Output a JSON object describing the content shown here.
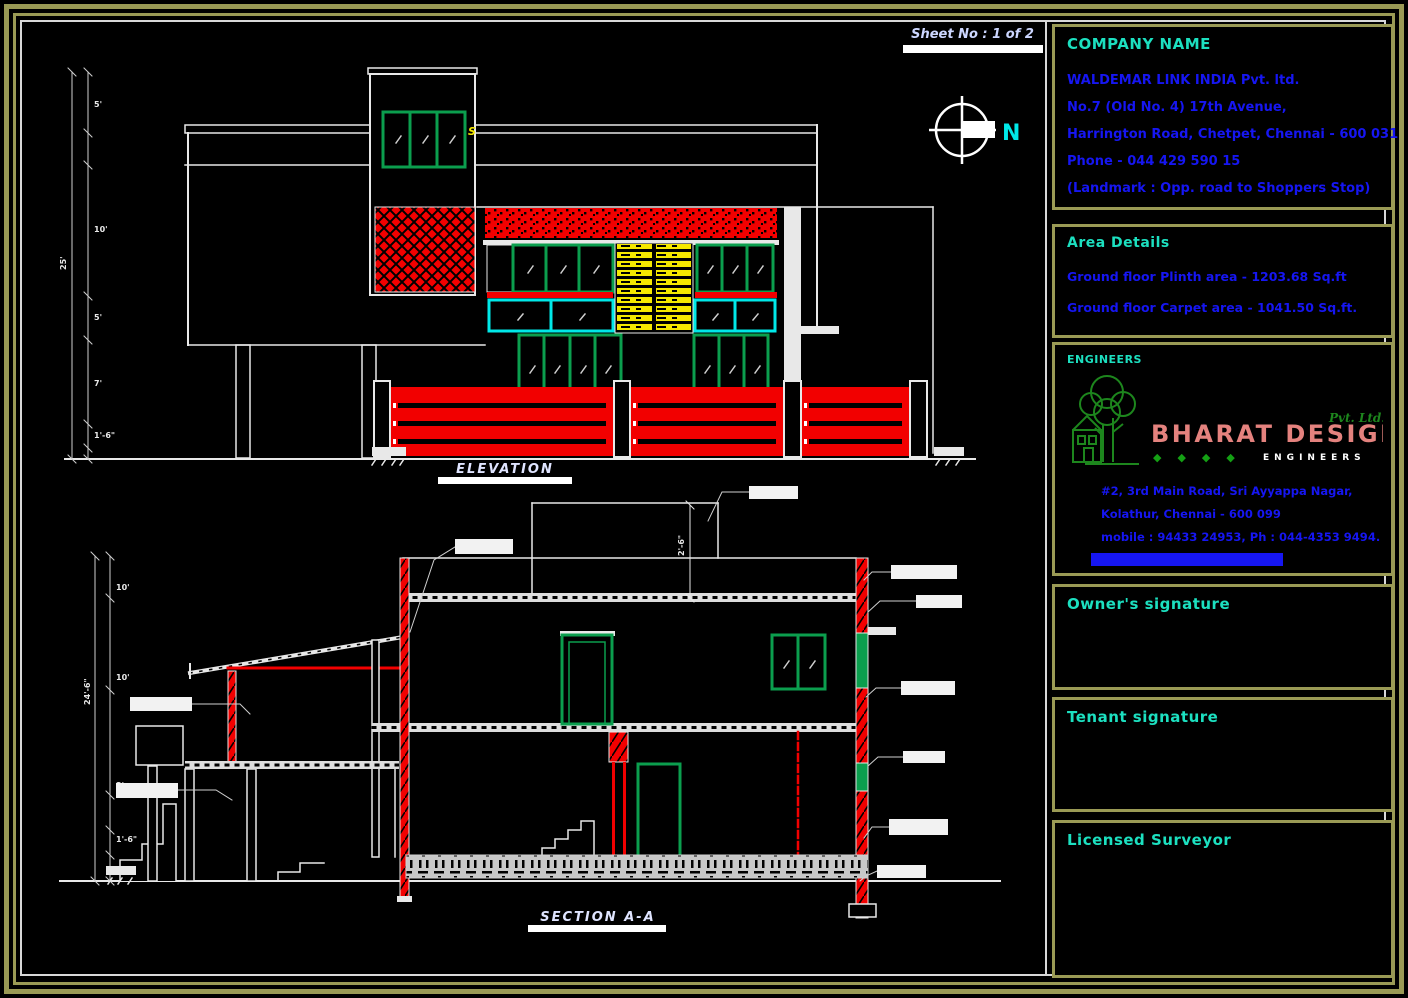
{
  "sheet": {
    "number_label": "Sheet No : 1 of 2"
  },
  "compass": {
    "north_label": "N"
  },
  "drawing": {
    "elevation": {
      "title": "ELEVATION",
      "marker": "S",
      "dims": {
        "total": "25'",
        "segments": [
          "5'",
          "10'",
          "5'",
          "7'",
          "1'-6\""
        ]
      }
    },
    "section": {
      "title": "SECTION A-A",
      "dims": {
        "total": "24'-6\"",
        "segments": [
          "10'",
          "10'",
          "3'",
          "1'-6\"",
          "2'"
        ],
        "mumty": "2'-6\""
      }
    }
  },
  "panels": {
    "company": {
      "heading": "COMPANY NAME",
      "lines": [
        "WALDEMAR LINK INDIA Pvt. ltd.",
        "No.7 (Old No. 4) 17th Avenue,",
        "Harrington Road, Chetpet, Chennai - 600 031",
        "Phone - 044 429 590 15",
        "(Landmark : Opp. road to Shoppers Stop)"
      ]
    },
    "area": {
      "heading": "Area Details",
      "lines": [
        "Ground floor Plinth area - 1203.68 Sq.ft",
        "Ground floor Carpet area - 1041.50 Sq.ft."
      ]
    },
    "engineers": {
      "heading": "ENGINEERS",
      "brand": "BHARAT DESIGN",
      "brand_suffix": "Pvt. Ltd.",
      "brand_tagline": "ENGINEERS",
      "diamonds": "◆◆◆◆",
      "address": [
        "#2, 3rd Main Road, Sri Ayyappa Nagar,",
        "Kolathur, Chennai - 600 099",
        "mobile : 94433 24953, Ph : 044-4353 9494."
      ]
    },
    "owner": {
      "heading": "Owner's signature"
    },
    "tenant": {
      "heading": "Tenant signature"
    },
    "surveyor": {
      "heading": "Licensed Surveyor"
    }
  },
  "colors": {
    "cad_red": "#f20000",
    "cad_green": "#0b9e4e",
    "cad_yellow": "#f5e800",
    "cad_cyan": "#00e8e8",
    "cad_blue": "#1616f2",
    "heading_teal": "#1ce0c0",
    "frame_khaki": "#9a9a55",
    "logo_pink": "#e4827e",
    "tree_green": "#1d861d",
    "plinth_gray": "#c8c8c8"
  }
}
